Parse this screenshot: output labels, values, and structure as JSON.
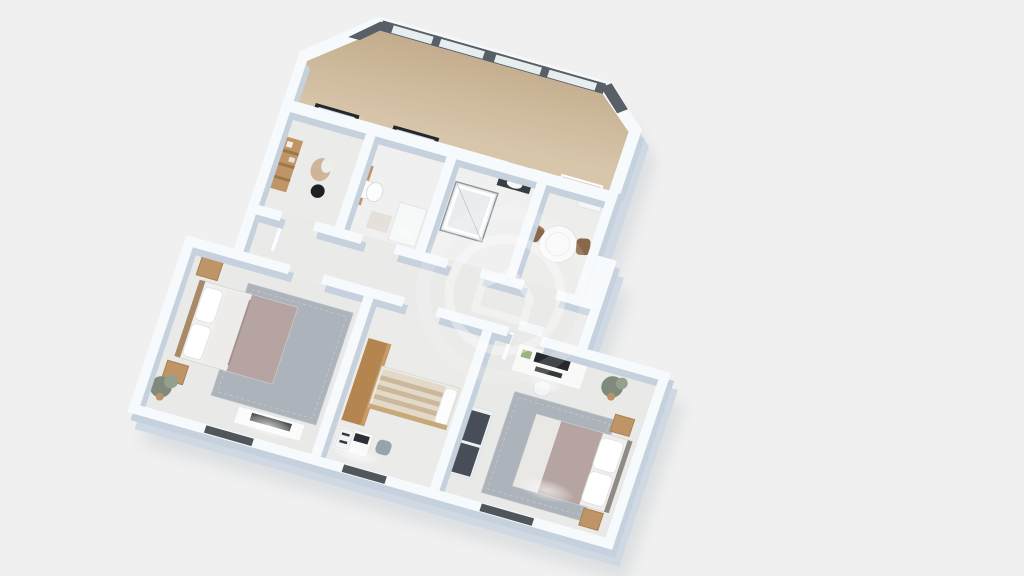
{
  "scene": {
    "type": "3d-floorplan-render",
    "view": "axonometric-top-down",
    "rotation_deg": 16,
    "storeys": 1
  },
  "colors": {
    "background": "#f0f0f0",
    "base": "#f3f6f9",
    "wall_top": "#f7fafc",
    "wall_side": "#cfd9e4",
    "wall_inner_side": "#c6d1de",
    "shadow": "#9aa4b0",
    "floor": "#ebecea",
    "floor_bedroom": "#e9eae8",
    "floor_bath": "#eff0ef",
    "wood_floor_light": "#d8c6ab",
    "wood_floor_dark": "#c2ab8b",
    "window_frame": "#585f66",
    "skylight_frame": "#23272a",
    "glass": "#e8edf0",
    "bottom_window": "#51565b",
    "rug": "#adb3ba",
    "blanket": "#b5a4a1",
    "wood": "#bf9466",
    "wood_dark": "#b5854f",
    "dark": "#272a2d",
    "plant": "#7f8a7c",
    "white_furniture": "#f9f9f8",
    "watermark": "#ffffff"
  },
  "watermark": {
    "shape": "circle-with-house-logo",
    "opacity": "0.35"
  },
  "rooms": [
    {
      "id": "attic-loft",
      "floor": "wood",
      "features": [
        "sloped-roof",
        "skylight-window-band"
      ]
    },
    {
      "id": "entry-hall",
      "furniture": [
        "ladder-shelf",
        "coat-stand",
        "skylight-window"
      ]
    },
    {
      "id": "bathroom",
      "furniture": [
        "toilet",
        "wood-trim",
        "counter",
        "bath-mat",
        "skylight-window"
      ]
    },
    {
      "id": "shower-room",
      "furniture": [
        "glass-shower-cabin",
        "wall-sink-shelf",
        "mirror"
      ]
    },
    {
      "id": "dining-nook",
      "furniture": [
        "round-table",
        "chair",
        "chair",
        "wall-niche",
        "radiator"
      ]
    },
    {
      "id": "hallway",
      "furniture": [
        "door-leaf",
        "door-leaf",
        "threshold"
      ]
    },
    {
      "id": "bedroom-left",
      "furniture": [
        "double-bed",
        "rug",
        "nightstand",
        "nightstand",
        "wall-art",
        "plant",
        "tv-stand",
        "tv"
      ]
    },
    {
      "id": "study-bedroom",
      "furniture": [
        "wardrobe",
        "daybed",
        "desk",
        "desk-chair"
      ]
    },
    {
      "id": "bedroom-right",
      "furniture": [
        "desk",
        "monitor",
        "keyboard",
        "desk-stool",
        "wardrobe",
        "rug",
        "double-bed",
        "nightstand",
        "nightstand",
        "plant"
      ]
    }
  ]
}
